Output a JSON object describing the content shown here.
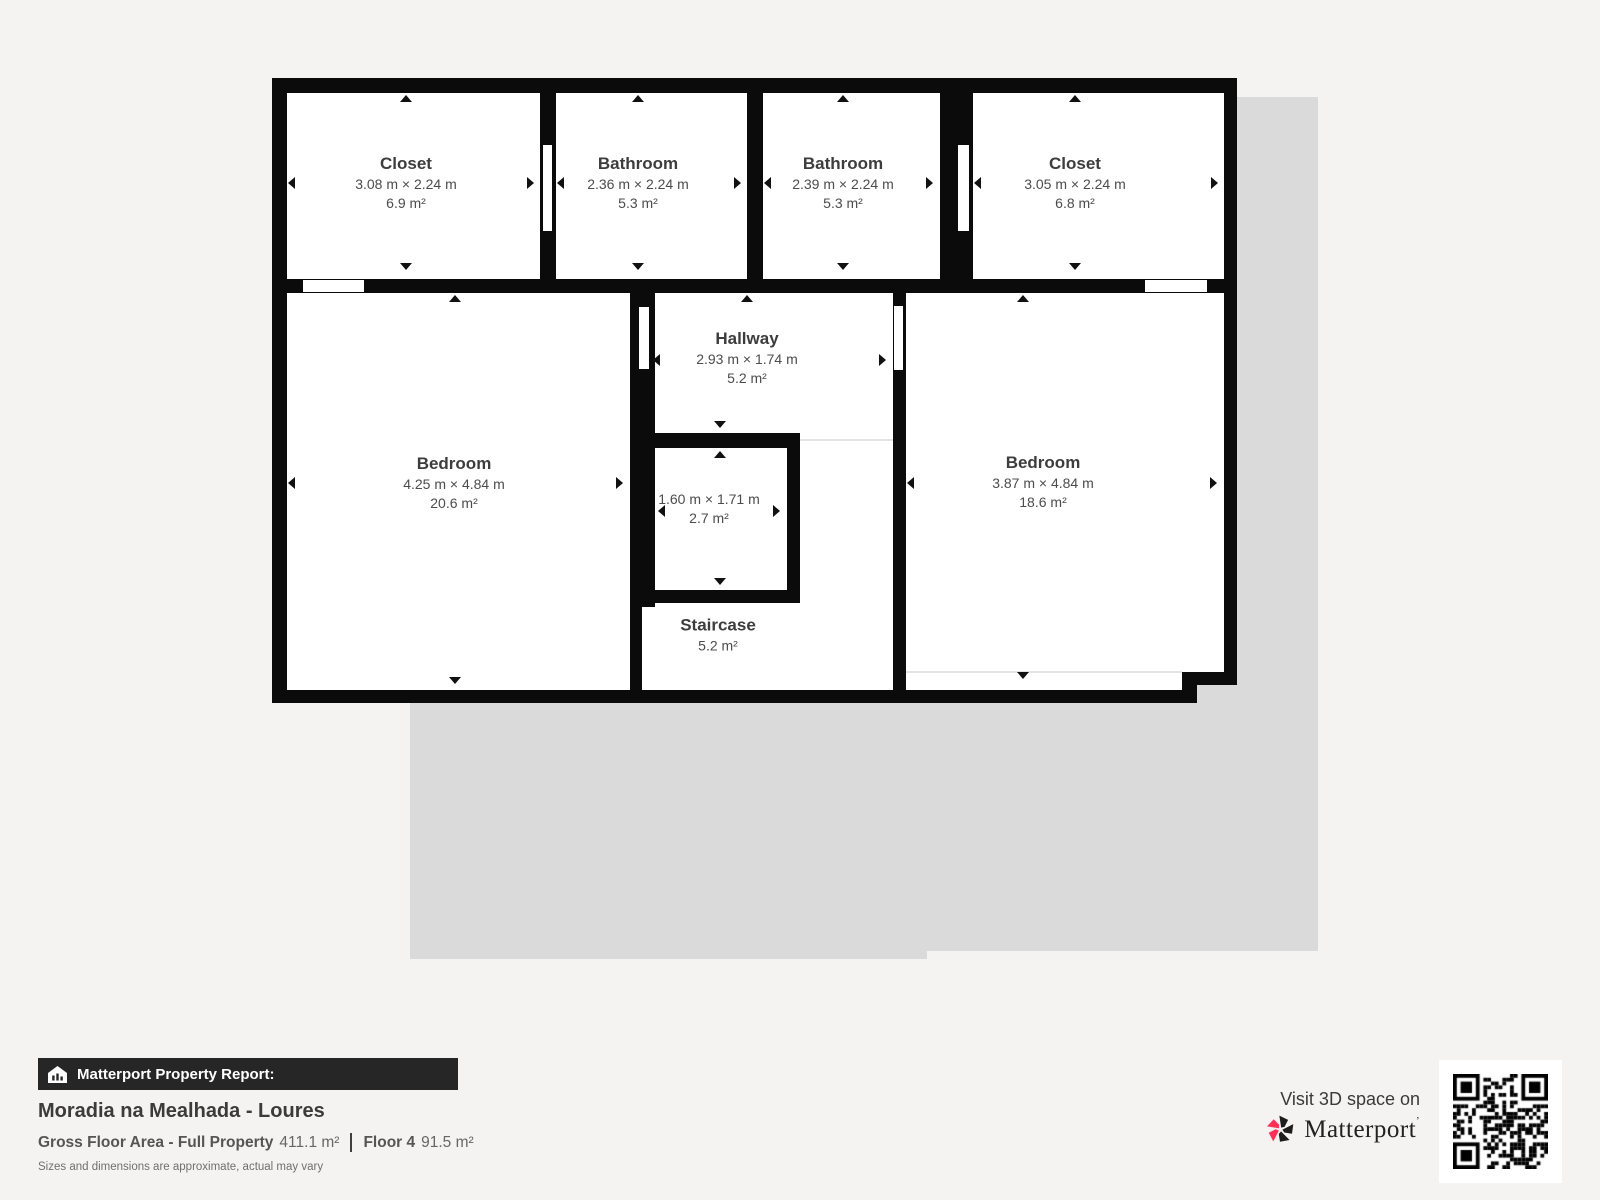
{
  "floorplan": {
    "rooms": {
      "closet_left": {
        "name": "Closet",
        "dims": "3.08 m × 2.24 m",
        "area": "6.9 m²"
      },
      "bathroom_left": {
        "name": "Bathroom",
        "dims": "2.36 m × 2.24 m",
        "area": "5.3 m²"
      },
      "bathroom_right": {
        "name": "Bathroom",
        "dims": "2.39 m × 2.24 m",
        "area": "5.3 m²"
      },
      "closet_right": {
        "name": "Closet",
        "dims": "3.05 m × 2.24 m",
        "area": "6.8 m²"
      },
      "hallway": {
        "name": "Hallway",
        "dims": "2.93 m × 1.74 m",
        "area": "5.2 m²"
      },
      "bedroom_left": {
        "name": "Bedroom",
        "dims": "4.25 m × 4.84 m",
        "area": "20.6 m²"
      },
      "bedroom_right": {
        "name": "Bedroom",
        "dims": "3.87 m × 4.84 m",
        "area": "18.6 m²"
      },
      "small_room": {
        "name": "",
        "dims": "1.60 m × 1.71 m",
        "area": "2.7 m²"
      },
      "staircase": {
        "name": "Staircase",
        "dims": "",
        "area": "5.2 m²"
      }
    }
  },
  "report": {
    "header": "Matterport Property Report:",
    "title": "Moradia na Mealhada - Loures",
    "gross_label": "Gross Floor Area - Full Property",
    "gross_value": "411.1 m²",
    "floor_label": "Floor 4",
    "floor_value": "91.5 m²",
    "disclaimer": "Sizes and dimensions are approximate, actual may vary"
  },
  "cta": {
    "visit_text": "Visit 3D space on",
    "brand": "Matterport",
    "brand_mark": "’"
  },
  "icons": {
    "report_bar": "house-report-icon",
    "brand": "matterport-pinwheel-icon",
    "qr": "qr-code"
  },
  "colors": {
    "background": "#f4f3f1",
    "wall": "#0b0b0b",
    "shadow": "#dadada",
    "accent_pink": "#ff3158",
    "bar_background": "#262626"
  }
}
